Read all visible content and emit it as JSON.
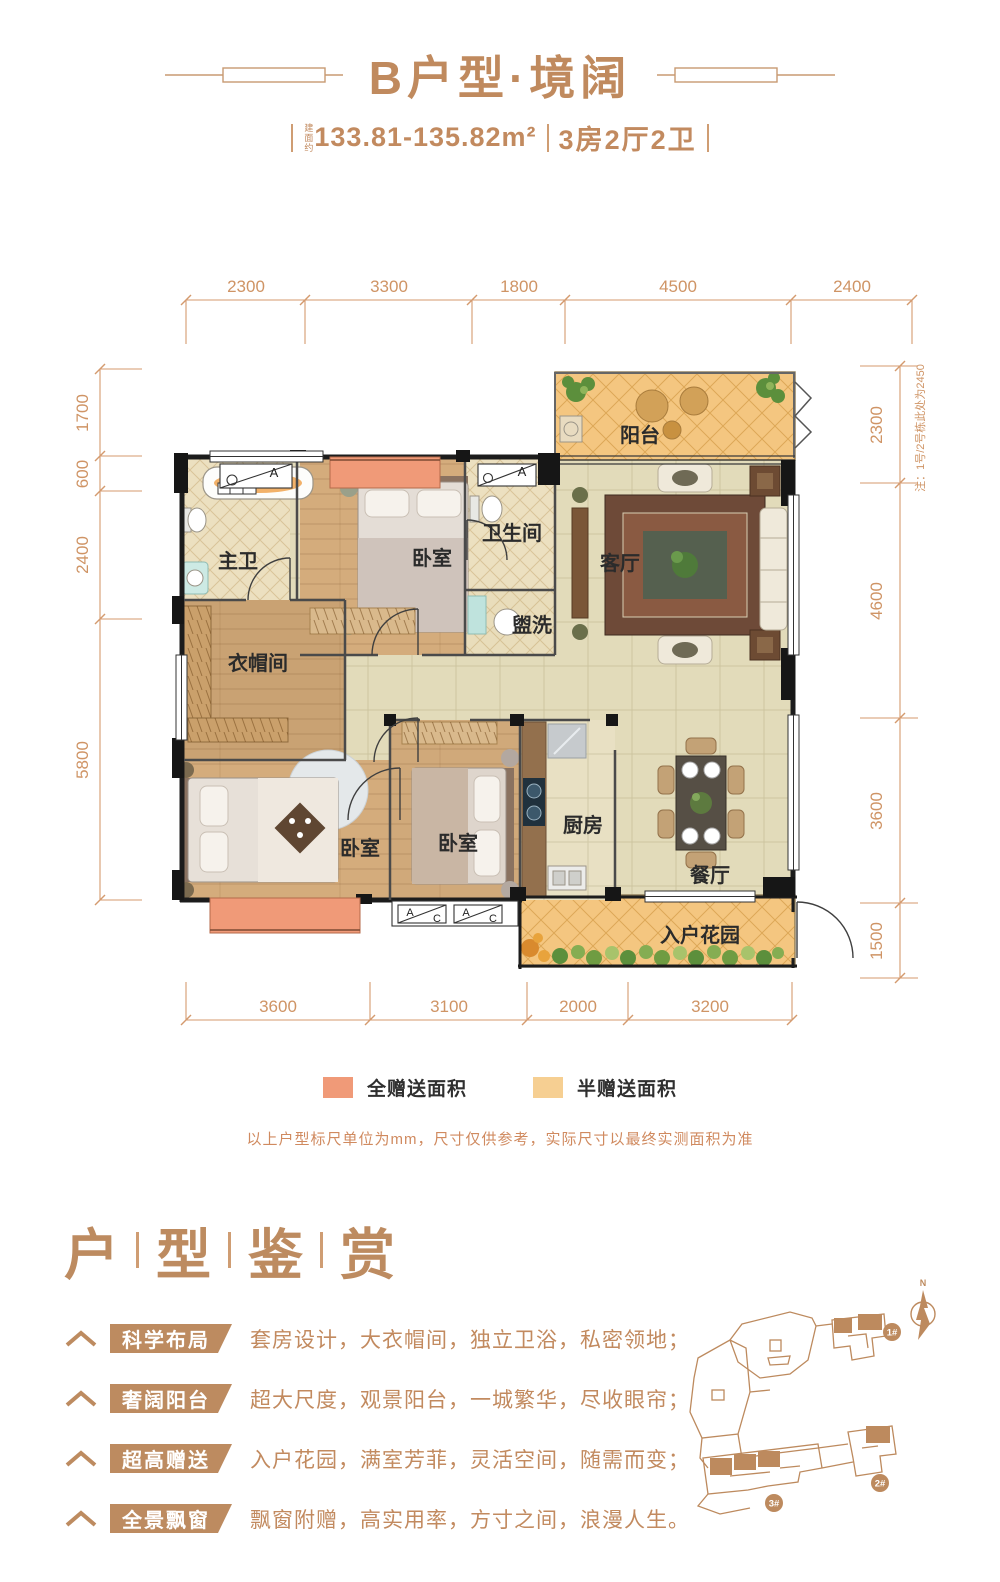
{
  "colors": {
    "accent_tan": "#bd8b60",
    "full_gift_orange": "#f09a78",
    "half_gift_yellow": "#f6cf92",
    "wall_black": "#1c1c1c",
    "dim_line": "#d49a6e"
  },
  "header": {
    "title": "B户型·境阔",
    "area_prefix": "建面约",
    "area": "133.81-135.82m²",
    "rooms_spec": "3房2厅2卫"
  },
  "plan": {
    "dims_top": [
      "2300",
      "3300",
      "1800",
      "4500",
      "2400"
    ],
    "dims_left": [
      "1700",
      "600",
      "2400",
      "5800"
    ],
    "dims_right": [
      "2300",
      "4600",
      "3600",
      "1500"
    ],
    "dims_bottom": [
      "3600",
      "3100",
      "2000",
      "3200"
    ],
    "side_note": "注：1号/2号栋此处为2450",
    "rooms": {
      "balcony": "阳台",
      "living": "客厅",
      "master_bath": "主卫",
      "bedroom_top": "卧室",
      "bathroom": "卫生间",
      "wash": "盥洗",
      "cloakroom": "衣帽间",
      "bedroom_left": "卧室",
      "bedroom_mid": "卧室",
      "kitchen": "厨房",
      "dining": "餐厅",
      "garden": "入户花园"
    },
    "marker_a": "A",
    "marker_c": "C"
  },
  "legend": {
    "full": "全赠送面积",
    "half": "半赠送面积",
    "note": "以上户型标尺单位为mm，尺寸仅供参考，实际尺寸以最终实测面积为准"
  },
  "section": {
    "c1": "户",
    "c2": "型",
    "c3": "鉴",
    "c4": "赏"
  },
  "features": [
    {
      "tag": "科学布局",
      "desc": "套房设计，大衣帽间，独立卫浴，私密领地；"
    },
    {
      "tag": "奢阔阳台",
      "desc": "超大尺度，观景阳台，一城繁华，尽收眼帘；"
    },
    {
      "tag": "超高赠送",
      "desc": "入户花园，满室芳菲，灵活空间，随需而变；"
    },
    {
      "tag": "全景飘窗",
      "desc": "飘窗附赠，高实用率，方寸之间，浪漫人生。"
    }
  ],
  "siteplan": {
    "b1": "1#",
    "b2": "2#",
    "b3": "3#",
    "north": "N"
  }
}
